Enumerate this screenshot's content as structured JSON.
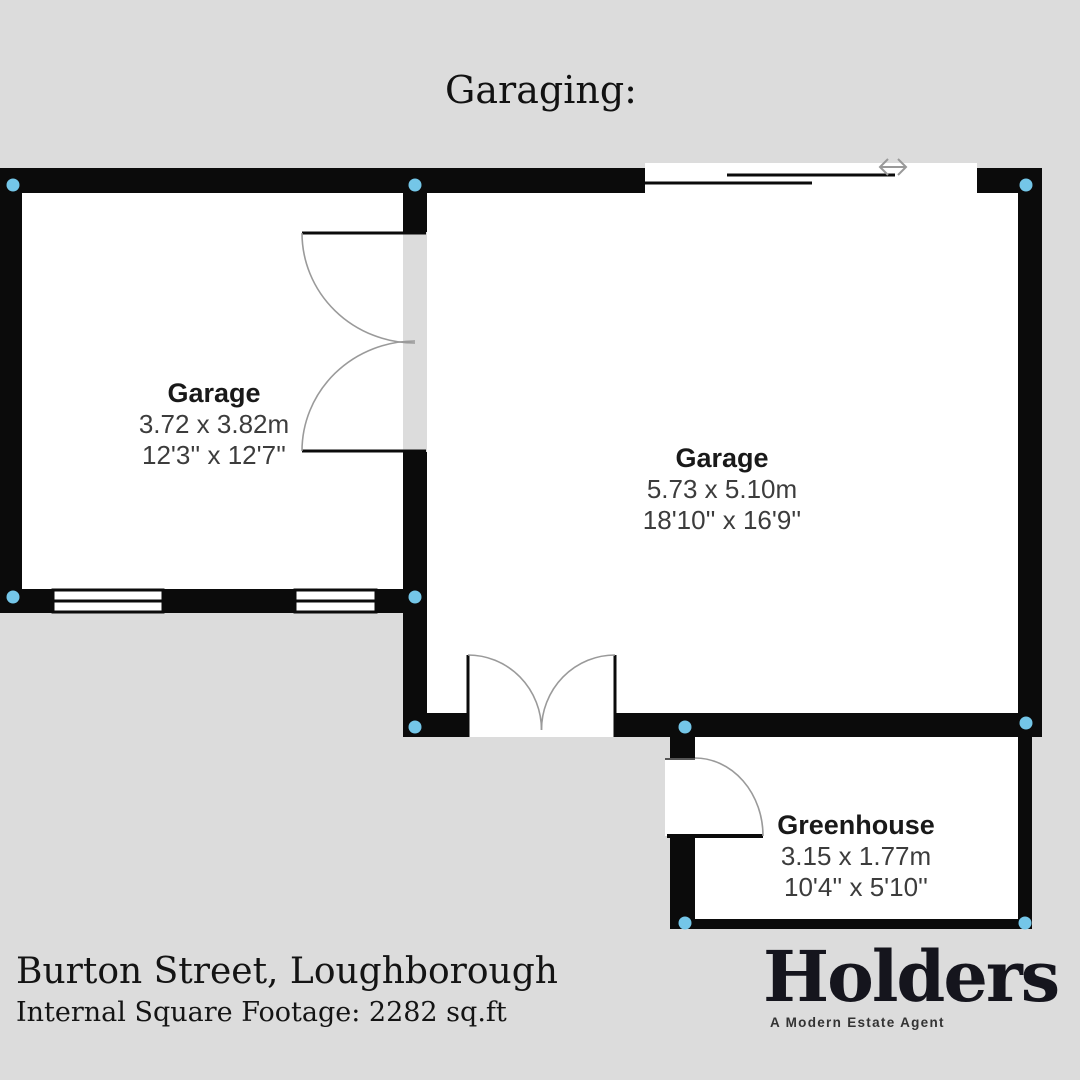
{
  "title": "Garaging:",
  "plan": {
    "background_color": "#dcdcdc",
    "wall_color": "#0b0b0b",
    "floor_color": "#ffffff",
    "corner_dot_color": "#74c6e8",
    "door_arc_color": "#9a9a9a"
  },
  "rooms": [
    {
      "name": "Garage",
      "metric": "3.72 x 3.82m",
      "imperial": "12'3'' x 12'7''"
    },
    {
      "name": "Garage",
      "metric": "5.73 x 5.10m",
      "imperial": "18'10'' x 16'9''"
    },
    {
      "name": "Greenhouse",
      "metric": "3.15 x 1.77m",
      "imperial": "10'4'' x 5'10''"
    }
  ],
  "footer": {
    "address": "Burton Street, Loughborough",
    "footage": "Internal Square Footage: 2282 sq.ft"
  },
  "brand": {
    "name": "Holders",
    "tagline": "A Modern Estate Agent"
  }
}
